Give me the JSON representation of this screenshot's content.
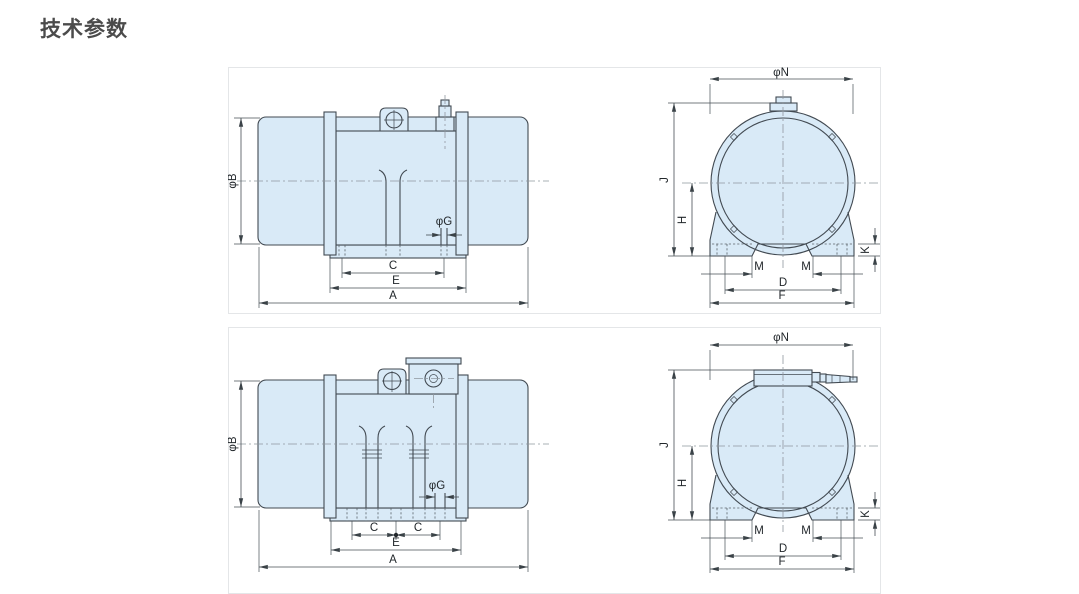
{
  "page": {
    "title": "技术参数"
  },
  "colors": {
    "body_fill": "#d9eaf7",
    "outline": "#424a52",
    "dimension": "#474f55",
    "centerline": "#8f979e",
    "panel_border": "#e4e6e8",
    "title_text": "#4b4b4b",
    "background": "#ffffff"
  },
  "panels": [
    {
      "id": "top",
      "side_view": {
        "labels": {
          "diaB": "φB",
          "diaG": "φG",
          "C": "C",
          "E": "E",
          "A": "A"
        }
      },
      "end_view": {
        "labels": {
          "diaN": "φN",
          "J": "J",
          "H": "H",
          "K": "K",
          "M_left": "M",
          "M_right": "M",
          "D": "D",
          "F": "F"
        }
      }
    },
    {
      "id": "bottom",
      "side_view": {
        "labels": {
          "diaB": "φB",
          "diaG": "φG",
          "C_left": "C",
          "C_right": "C",
          "E": "E",
          "A": "A"
        }
      },
      "end_view": {
        "labels": {
          "diaN": "φN",
          "J": "J",
          "H": "H",
          "K": "K",
          "M_left": "M",
          "M_right": "M",
          "D": "D",
          "F": "F"
        }
      }
    }
  ]
}
